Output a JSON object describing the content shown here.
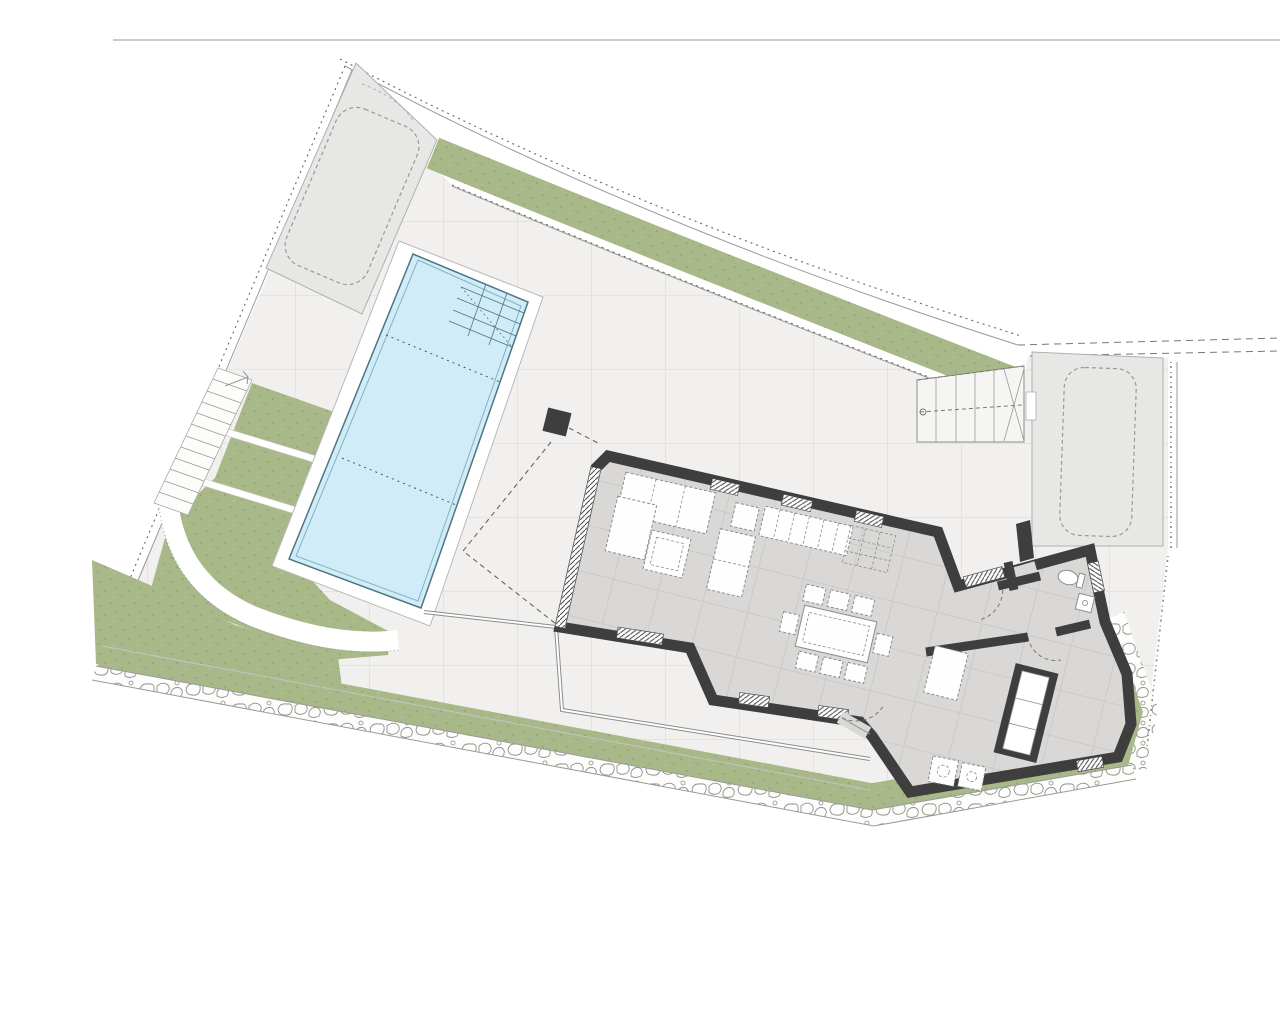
{
  "document": {
    "type": "architectural-site-plan",
    "view": "ground-floor-plan-with-plot"
  },
  "colors": {
    "background": "#ffffff",
    "plot_line": "#9a9a98",
    "boundary_dot": "#666664",
    "terrace": "#f1f0ee",
    "terrace_grid": "#e4e3e1",
    "green": "#a9b889",
    "green_dot": "#96a677",
    "path_white": "#ffffff",
    "rubble_line": "#8f8f8d",
    "stone_fill": "#fdfdfb",
    "pool_water": "#cfecf8",
    "pool_edge": "#4f7682",
    "pool_inner": "#84b2bf",
    "pool_dash": "#3c5a64",
    "coping": "#ffffff",
    "coping_line": "#b9b8b6",
    "pad": "#e7e7e5",
    "pad_line": "#b0b0ae",
    "car_dash": "#9a9a98",
    "wall": "#3e3e3e",
    "floor": "#d9d8d6",
    "floor_grid": "#cbcac8",
    "room_light": "#f5f5f3",
    "furniture_fill": "#fefefe",
    "furniture_line": "#8c8c8a",
    "hatch_line": "#4a4a48",
    "railing": "#8c8c8a",
    "dash_guide": "#777775"
  },
  "site": {
    "elements": [
      "plot-boundary",
      "lawn-strip-top",
      "lawn-strip-bottom",
      "rock-edge",
      "paved-terrace",
      "swimming-pool",
      "pool-steps",
      "garden-terraces",
      "garden-stairs",
      "curved-path",
      "parking-pad-upper",
      "parking-pad-right",
      "exterior-stairs",
      "house"
    ],
    "parking_spaces": 2
  },
  "house": {
    "rooms": [
      "living-dining-kitchen",
      "hallway",
      "bathroom",
      "bedroom"
    ],
    "furniture": [
      "sofa",
      "chaise",
      "armchair",
      "coffee-table",
      "side-table",
      "kitchen-counter",
      "kitchen-island",
      "dining-table",
      "dining-chairs",
      "toilet",
      "sink",
      "wardrobe",
      "desk",
      "laundry-units"
    ],
    "dining_chair_count": 8
  }
}
